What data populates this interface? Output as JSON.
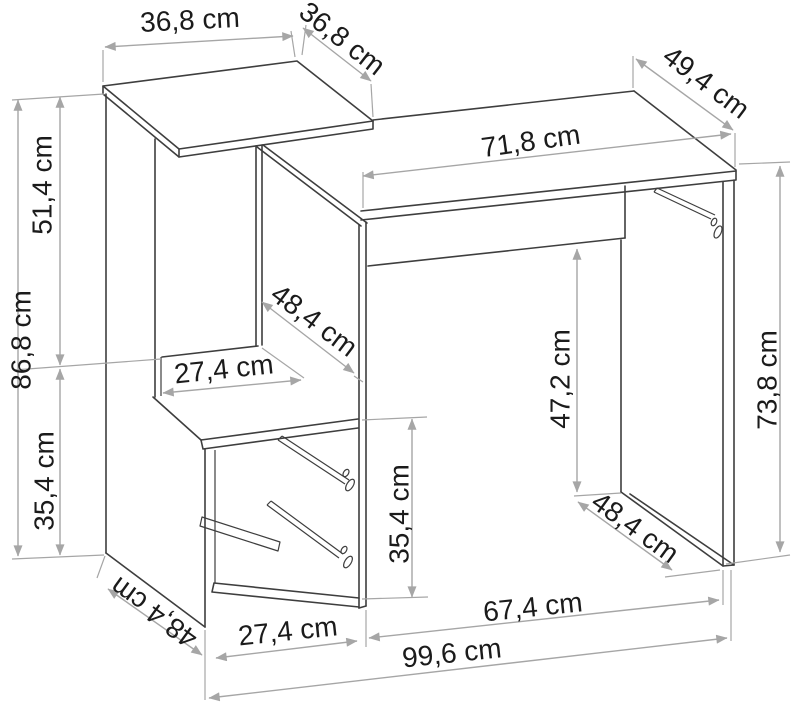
{
  "diagram": {
    "type": "furniture-dimension-drawing",
    "subject": "desk with side shelf tower and drawer cabinet",
    "unit": "cm",
    "colors": {
      "background": "#ffffff",
      "furniture_line": "#3e3e3e",
      "dimension_line": "#a6a6a6",
      "label_text": "#1b1b1b"
    },
    "dimensions": {
      "top_shelf_width": "36,8 cm",
      "top_shelf_depth": "36,8 cm",
      "desktop_width": "71,8 cm",
      "desktop_depth": "49,4 cm",
      "upper_section_height": "51,4 cm",
      "left_total_height": "86,8 cm",
      "left_lower_height": "35,4 cm",
      "middle_compartment_depth": "48,4 cm",
      "middle_shelf_width": "27,4 cm",
      "drawer_opening_height": "35,4 cm",
      "kneespace_height": "47,2 cm",
      "desk_height": "73,8 cm",
      "right_panel_depth": "48,4 cm",
      "base_depth": "48,4 cm",
      "drawer_width": "27,4 cm",
      "kneespace_width": "67,4 cm",
      "total_width": "99,6 cm"
    }
  }
}
